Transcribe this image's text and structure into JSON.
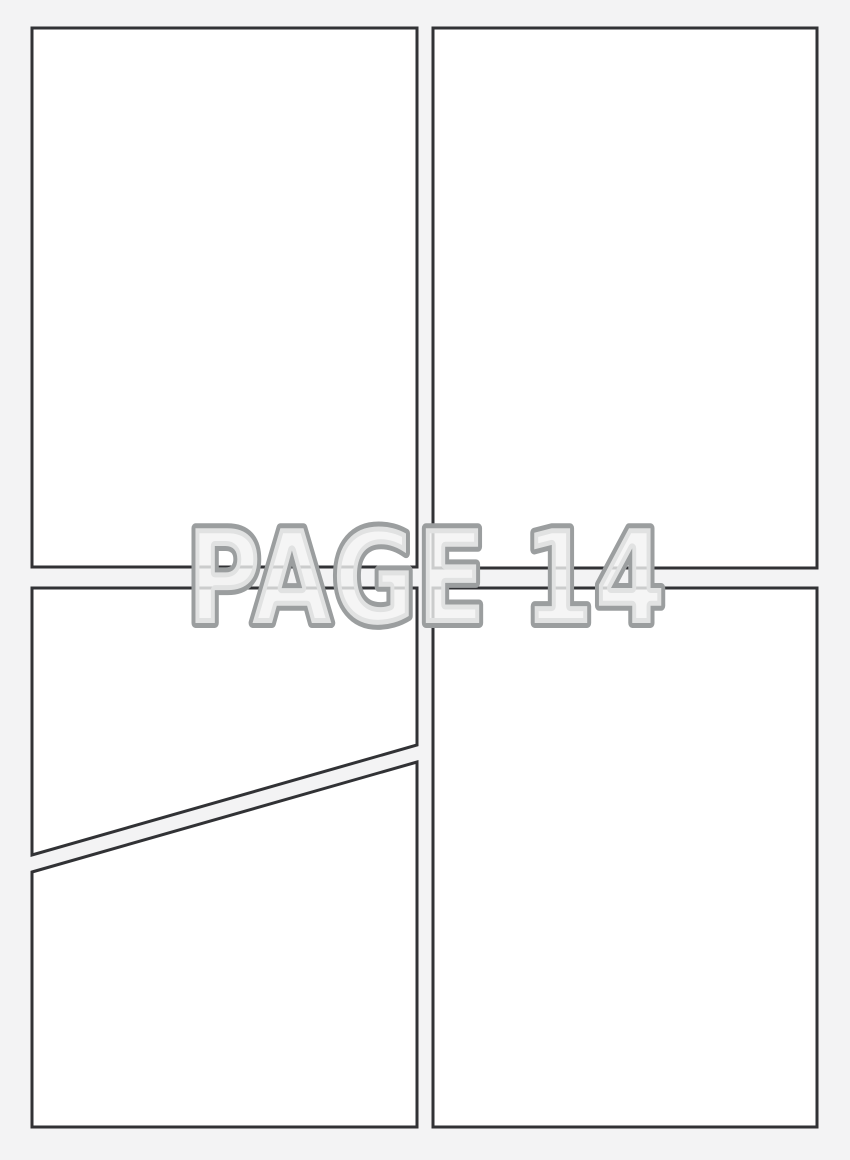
{
  "page": {
    "label": "PAGE 14"
  },
  "colors": {
    "background": "#f3f3f4",
    "panel_fill": "#ffffff",
    "panel_border": "#313235",
    "label_fill": "#f2f2f3",
    "label_outline": "#9b9e9f"
  },
  "panels": [
    {
      "name": "panel-top-left",
      "points": "32,28 417,28 417,567 32,567"
    },
    {
      "name": "panel-top-right",
      "points": "433,28 817,28 817,568 433,568"
    },
    {
      "name": "panel-middle-left",
      "points": "32,588 417,588 417,745 32,855"
    },
    {
      "name": "panel-bottom-left",
      "points": "32,872 417,762 417,1127 32,1127"
    },
    {
      "name": "panel-bottom-right",
      "points": "433,588 817,588 817,1127 433,1127"
    }
  ]
}
